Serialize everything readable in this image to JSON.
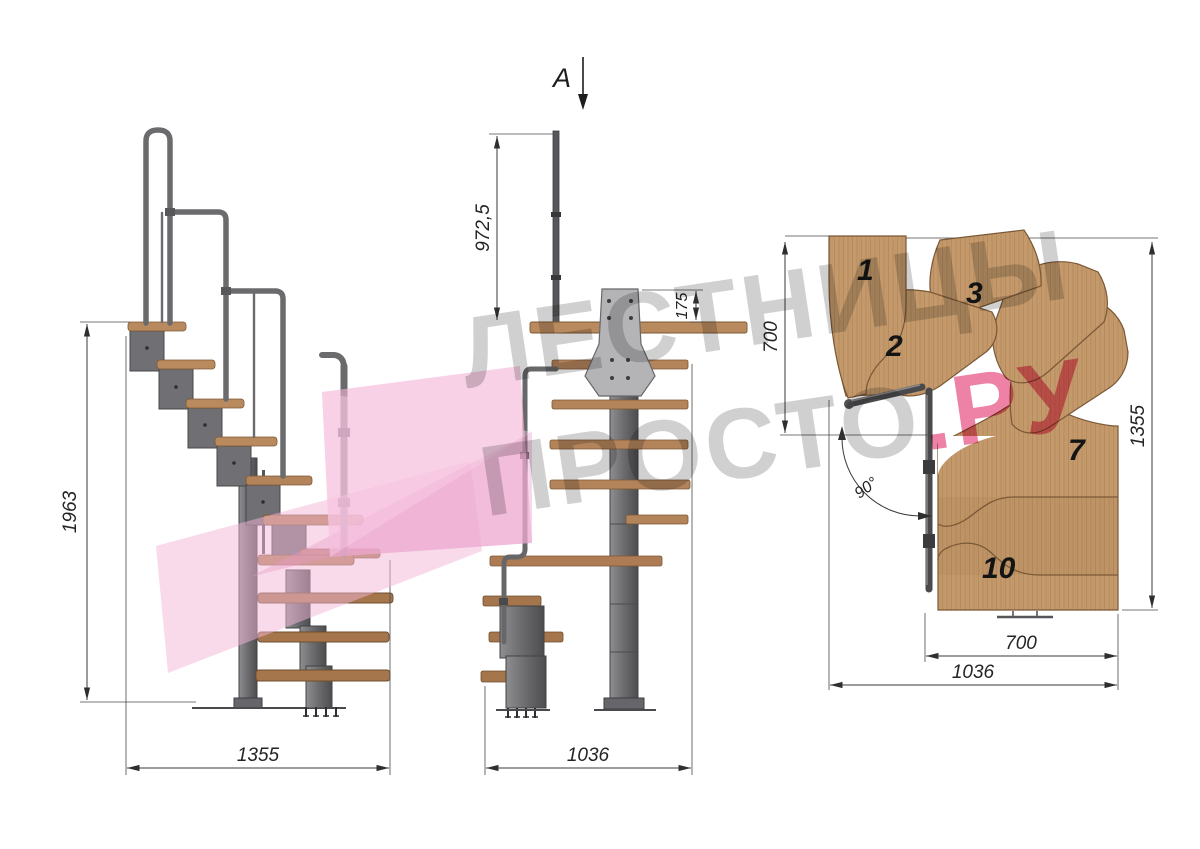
{
  "watermark": {
    "line1": "ЛЕСТНИЦЫ",
    "line2_gray": "ПРОСТО",
    "line2_accent": ".РУ",
    "text_color": "#8a8a8a",
    "accent_color": "#e2336f",
    "logo_pink": "#f3b5d8"
  },
  "section_cut": {
    "label": "A"
  },
  "side_view": {
    "height_mm": "1963",
    "width_mm": "1355"
  },
  "front_view": {
    "rail_height_mm": "972,5",
    "bracket_mm": "175",
    "width_mm": "1036"
  },
  "plan_view": {
    "run_top_mm": "700",
    "height_mm": "1355",
    "run_bottom_mm": "700",
    "width_mm": "1036",
    "turn_angle": "90°",
    "steps": [
      {
        "label": "1"
      },
      {
        "label": "2"
      },
      {
        "label": "3"
      },
      {
        "label": "7"
      },
      {
        "label": "10"
      }
    ]
  },
  "colors": {
    "wood": "#c49a6c",
    "wood_dark": "#9c6e45",
    "metal": "#77777a",
    "dimension": "#2f2f2f",
    "background": "#ffffff"
  }
}
